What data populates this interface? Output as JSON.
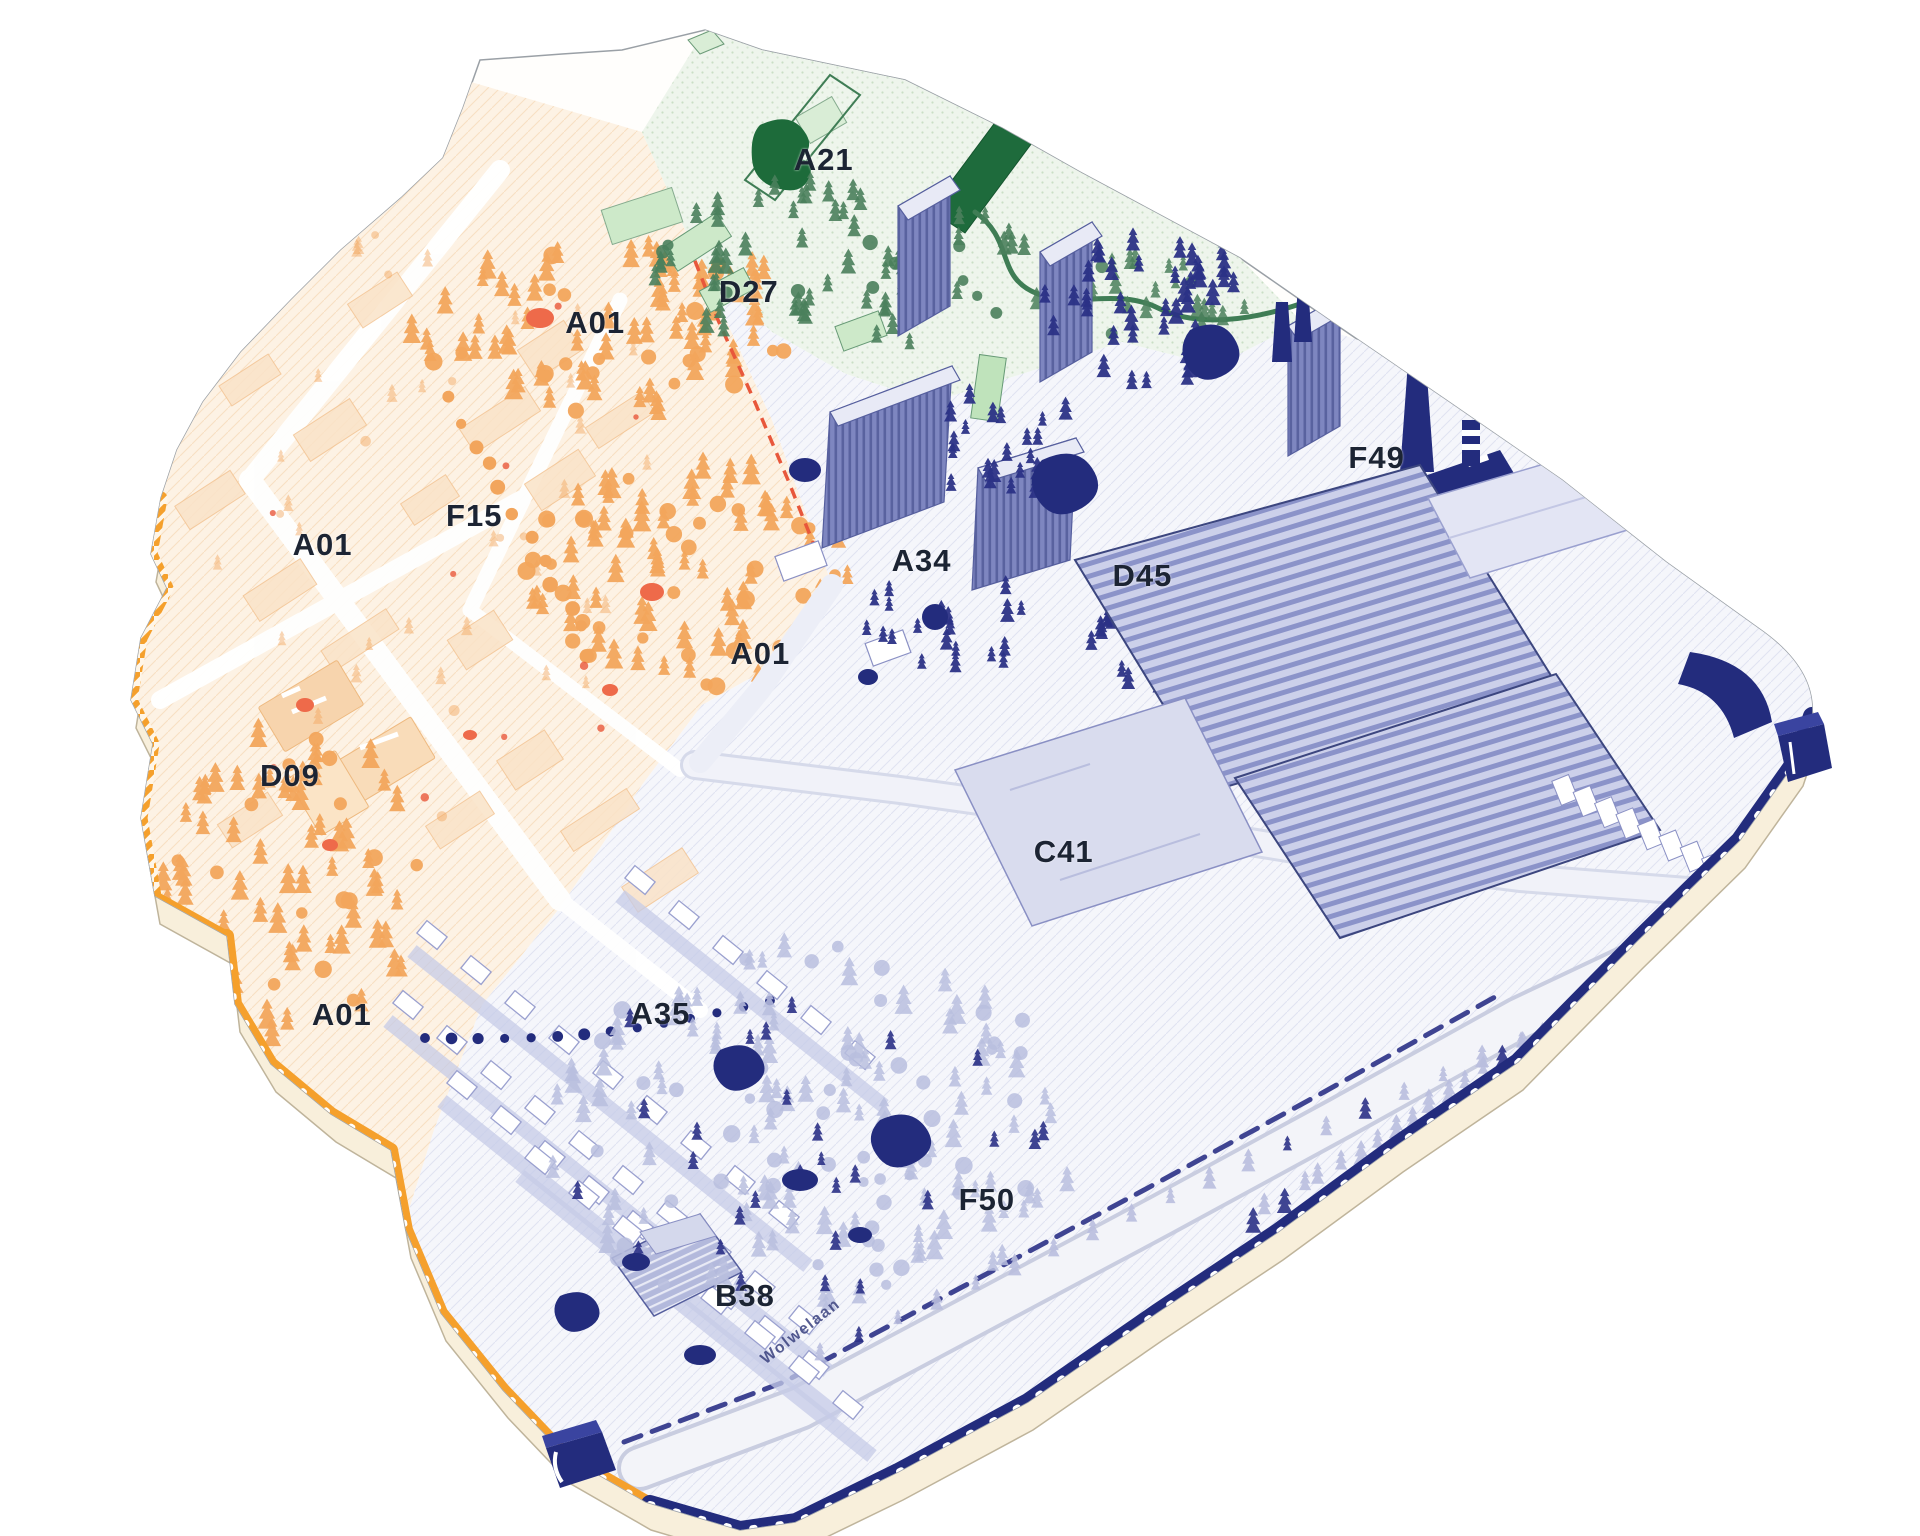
{
  "map": {
    "kind": "axonometric-masterplan-map",
    "zone_labels": [
      {
        "id": "a21",
        "text": "A21",
        "x_pct": 42.9,
        "y_pct": 10.4
      },
      {
        "id": "d27",
        "text": "D27",
        "x_pct": 39.0,
        "y_pct": 19.0
      },
      {
        "id": "a01-north",
        "text": "A01",
        "x_pct": 31.0,
        "y_pct": 21.0
      },
      {
        "id": "f15",
        "text": "F15",
        "x_pct": 24.7,
        "y_pct": 33.6
      },
      {
        "id": "a01-west",
        "text": "A01",
        "x_pct": 16.8,
        "y_pct": 35.5
      },
      {
        "id": "a34",
        "text": "A34",
        "x_pct": 48.0,
        "y_pct": 36.5
      },
      {
        "id": "f49",
        "text": "F49",
        "x_pct": 71.7,
        "y_pct": 29.8
      },
      {
        "id": "d45",
        "text": "D45",
        "x_pct": 59.5,
        "y_pct": 37.5
      },
      {
        "id": "a01-center",
        "text": "A01",
        "x_pct": 39.6,
        "y_pct": 42.6
      },
      {
        "id": "d09",
        "text": "D09",
        "x_pct": 15.1,
        "y_pct": 50.5
      },
      {
        "id": "c41",
        "text": "C41",
        "x_pct": 55.4,
        "y_pct": 55.5
      },
      {
        "id": "a35",
        "text": "A35",
        "x_pct": 34.4,
        "y_pct": 66.0
      },
      {
        "id": "a01-south",
        "text": "A01",
        "x_pct": 17.8,
        "y_pct": 66.1
      },
      {
        "id": "f50",
        "text": "F50",
        "x_pct": 51.4,
        "y_pct": 78.1
      },
      {
        "id": "b38",
        "text": "B38",
        "x_pct": 38.8,
        "y_pct": 84.4
      }
    ],
    "street": {
      "text": "Wolwelaan",
      "x_pct": 41.7,
      "y_pct": 86.7,
      "rotate_deg": -38
    },
    "colors": {
      "orange_accent": "#F5A02C",
      "orange_tree": "#F2A55C",
      "orange_pale": "#FDF1E3",
      "red_accent": "#E8573B",
      "salmon_blob": "#EE6A4A",
      "green_dark": "#1E6B3C",
      "green_mid": "#4A7F5C",
      "green_light": "#CDE8C9",
      "green_pale": "#EDF5EB",
      "periwinkle": "#7E86C0",
      "periwinkle_light": "#B9BEDE",
      "purple_pale": "#F4F5FB",
      "navy": "#232C7D",
      "cream_base": "#F8EFDB",
      "label_text": "#1C2433"
    }
  }
}
